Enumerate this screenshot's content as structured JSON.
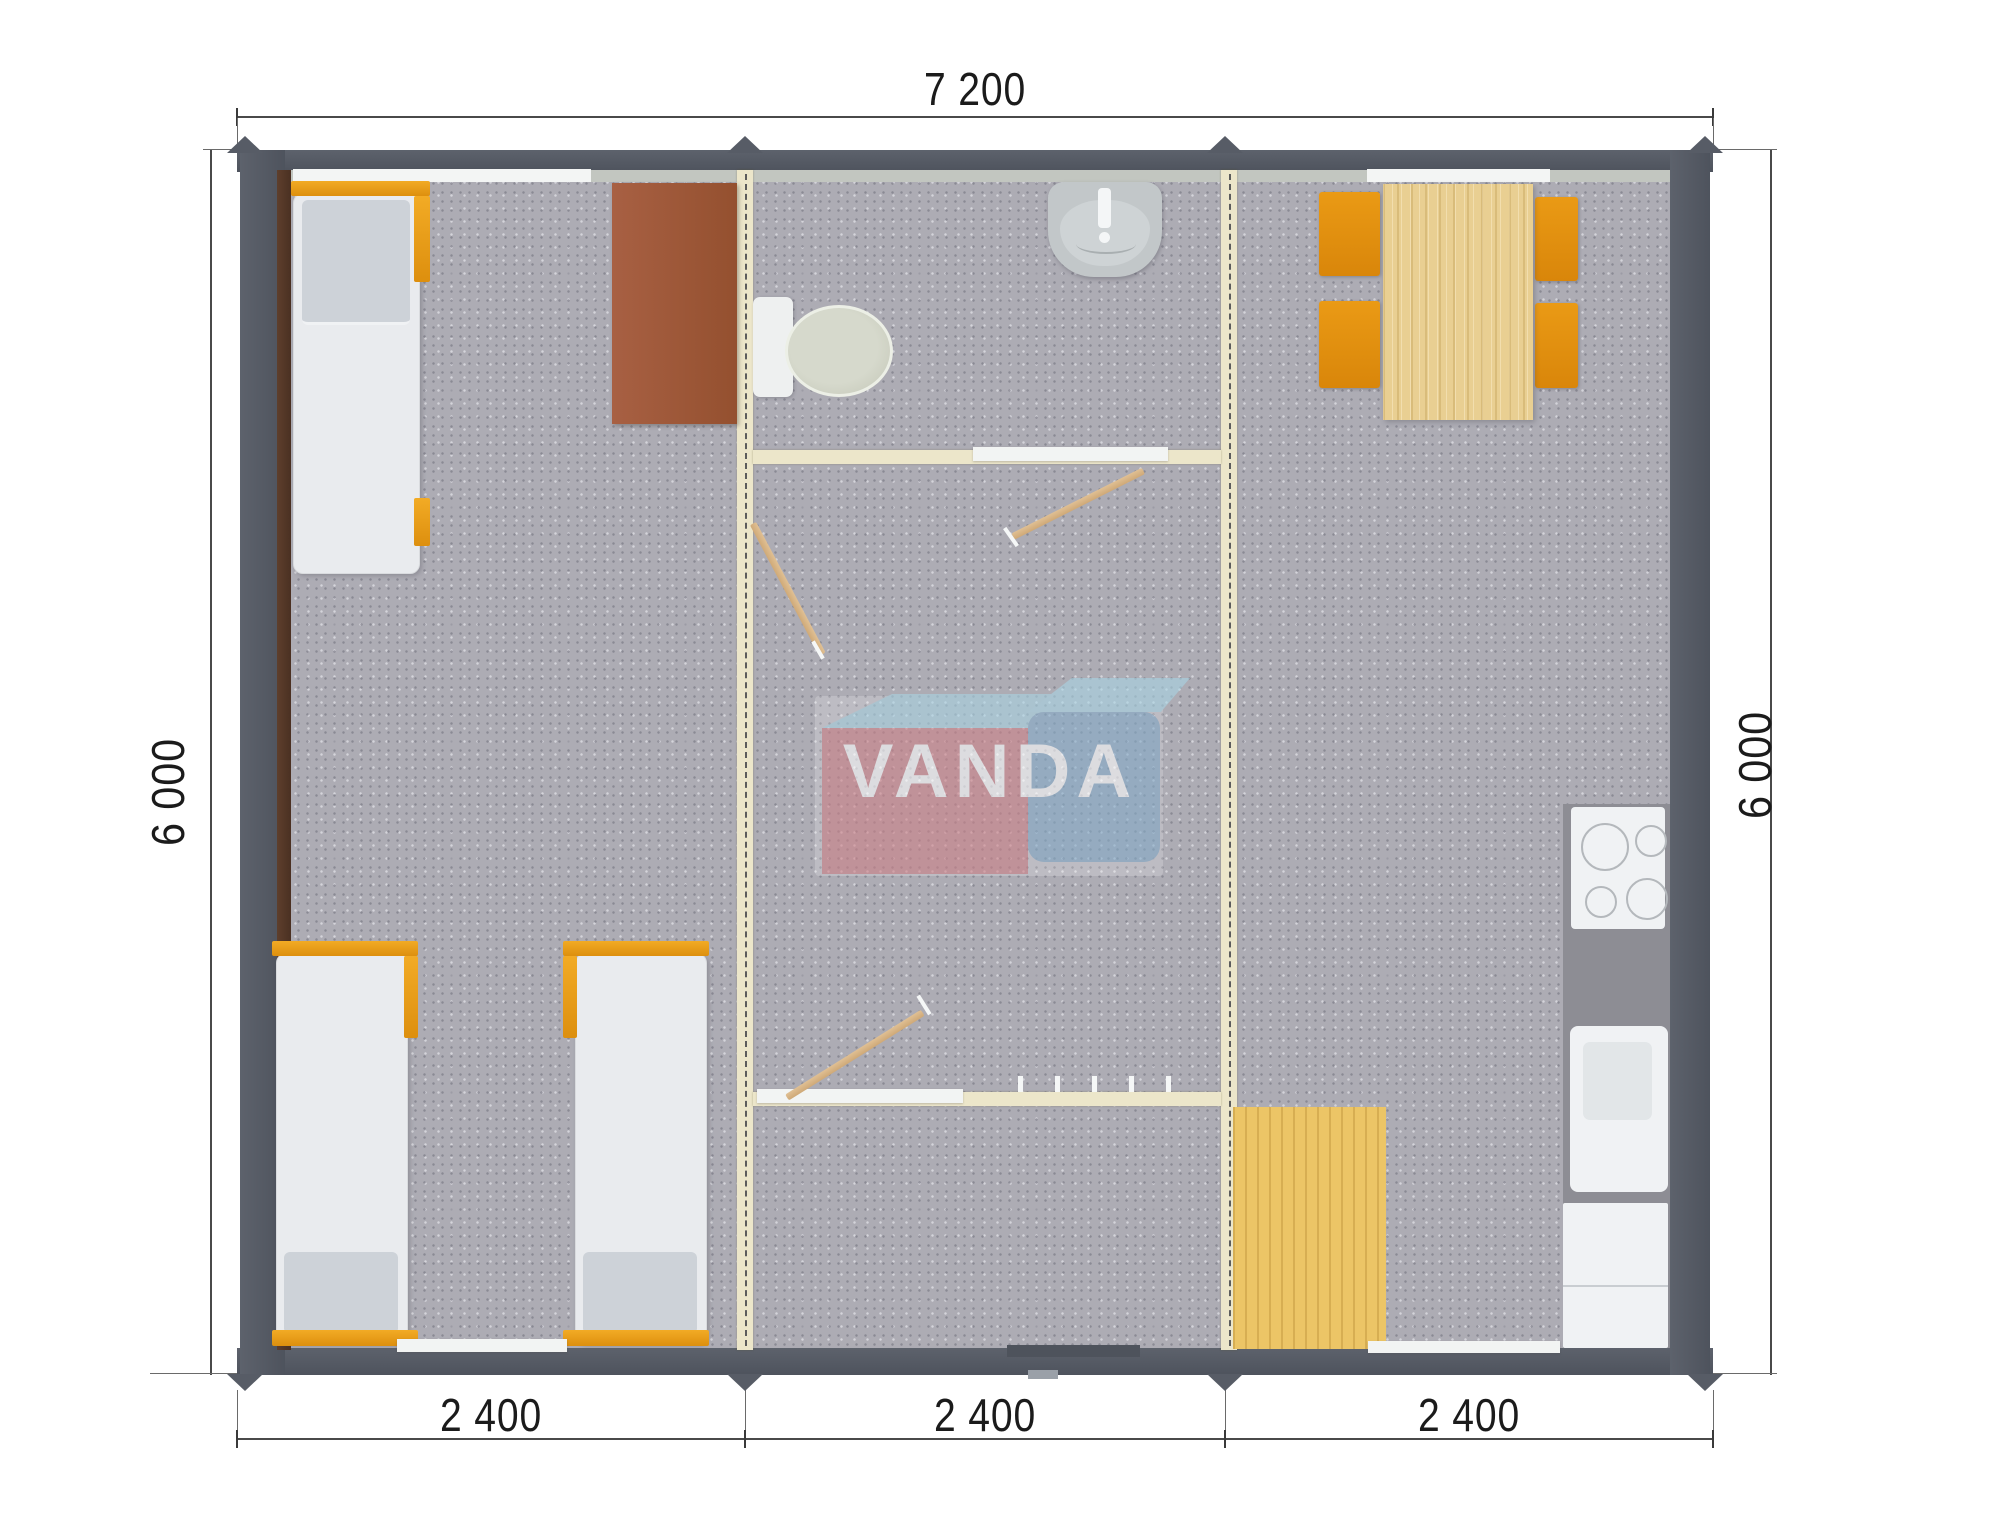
{
  "meta": {
    "kind": "modular-cabin-floor-plan-render",
    "brand": "VANDA"
  },
  "dimensions": {
    "top": "7 200",
    "bottom": [
      "2 400",
      "2 400",
      "2 400"
    ],
    "left": "6 000",
    "right": "6 000"
  },
  "logo": {
    "text": "VANDA",
    "part1": "VAN",
    "part2": "DA",
    "red_box_color": "#cf8087",
    "blue_box_color": "#84abc9",
    "top_face_color": "#a9d4e4"
  },
  "colors": {
    "outer_wall": "#575c66",
    "panel_wall_cream": "#ece6ca",
    "floor_gray": "#adacb4",
    "accent_orange": "#e89c1a",
    "table_wood": "#e9cf92",
    "mat_wood": "#ecc566",
    "desk_brown": "#a15c3f",
    "counter_gray": "#8d8d94"
  },
  "furniture": {
    "left_module": [
      "bed",
      "bed",
      "bed",
      "desk"
    ],
    "middle_module": [
      "toilet",
      "wash-basin",
      "interior-doors",
      "coat-hooks"
    ],
    "right_module": [
      "dining-table",
      "chairs-x4",
      "cooktop",
      "kitchen-sink",
      "fridge",
      "wood-floor-mat"
    ]
  }
}
